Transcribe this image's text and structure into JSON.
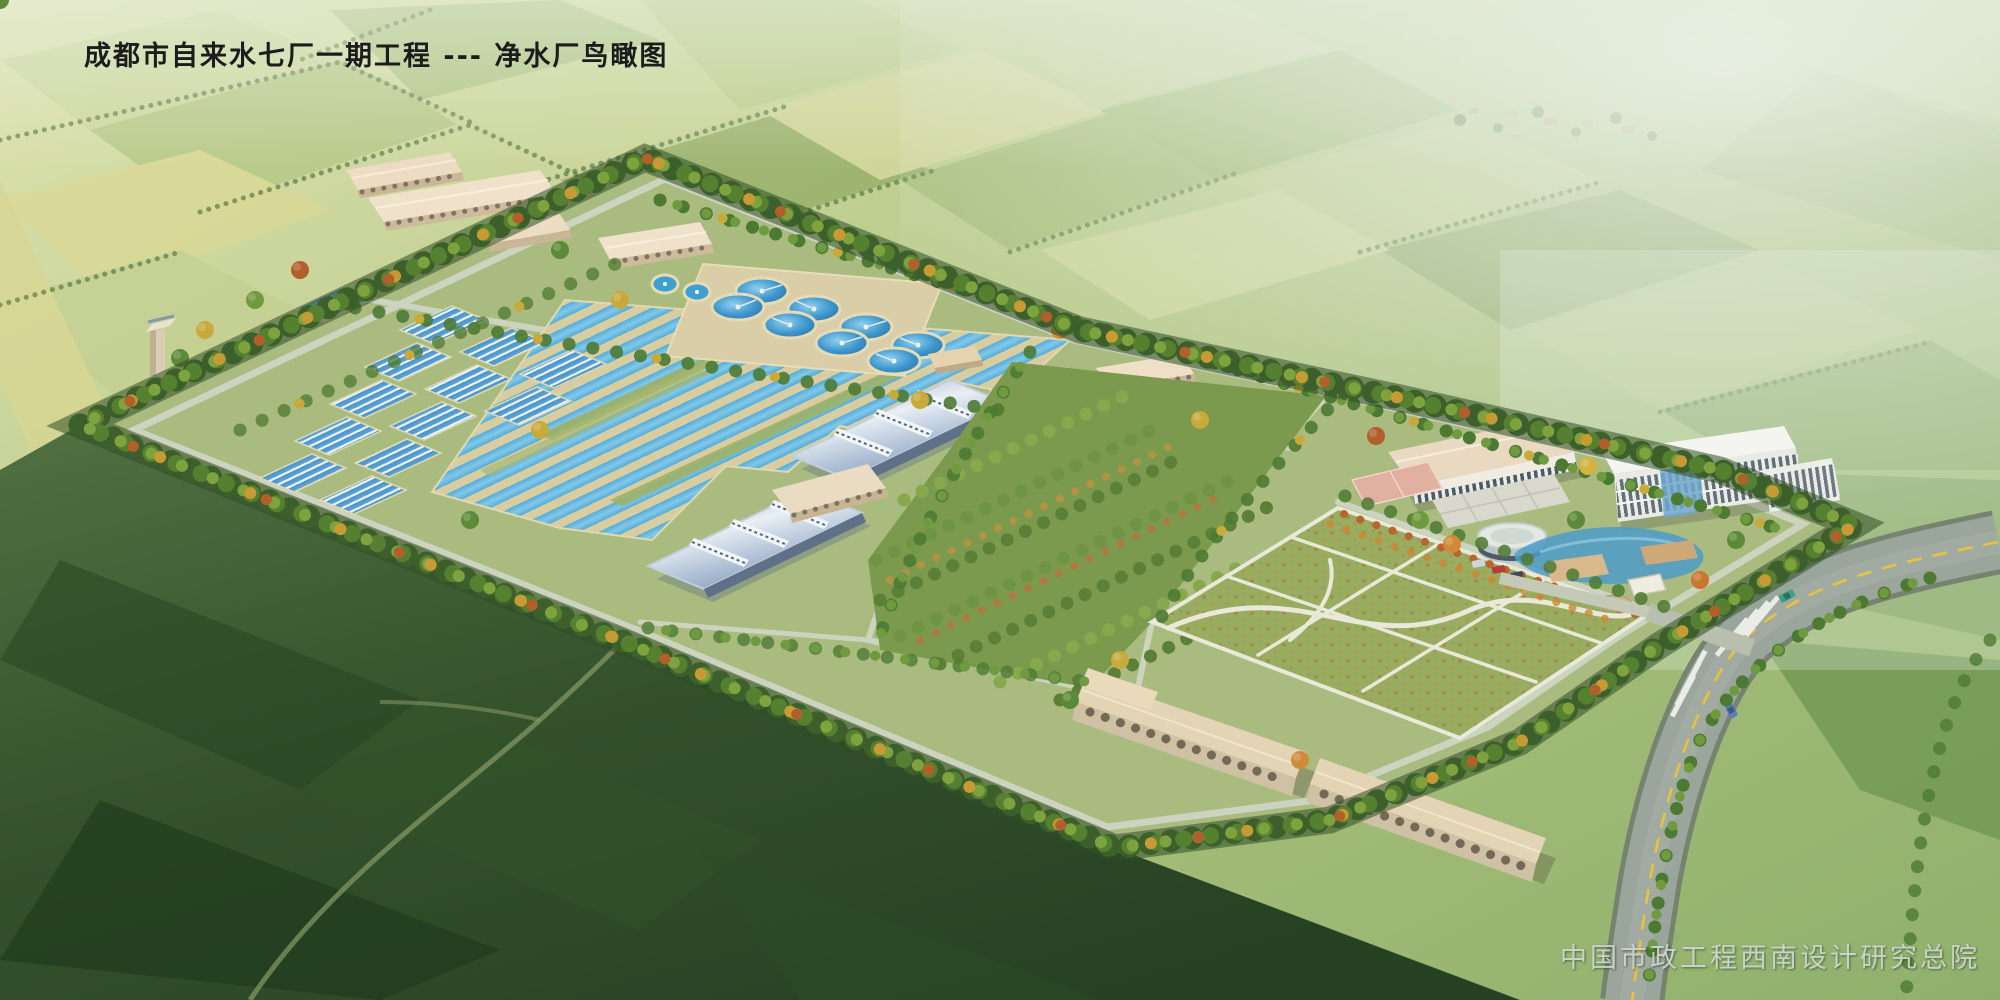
{
  "title": "成都市自来水七厂一期工程 --- 净水厂鸟瞰图",
  "credit": "中国市政工程西南设计研究总院",
  "scene": {
    "type": "architectural aerial perspective rendering",
    "subject_visible_in_title": "净水厂鸟瞰图",
    "circular_clarifiers": 8,
    "small_round_tanks": 2,
    "arch_roof_buildings": 2,
    "garage_rows": 2,
    "cars_on_highway": 3,
    "crosswalks": 2
  },
  "palette": {
    "field_light": "#d8dfae",
    "field_mid": "#a9bf7a",
    "field_dark": "#7fa05a",
    "haze": "#eaf2ec",
    "foreground_dark": "#27431f",
    "site_base": "#aabb80",
    "water_channel": "#5fb4de",
    "basin_wall": "#d8cda0",
    "panel_blue": "#4a92c8",
    "clarifier_blue": "#2e86c0",
    "roof_tan": "#e6d7bd",
    "roof_arch_blue": "#9fb4cc",
    "building_face": "#f2ece0",
    "office_white": "#f4f4f0",
    "tree_green": "#4f7a31",
    "tree_yellow": "#c9a93a",
    "tree_orange": "#b35f2c",
    "road_gray": "#9aa59b",
    "road_line_yellow": "#e8c33c",
    "path_light": "#e9e9da",
    "lawn_green": "#9aac60",
    "court_pink": "#e0b0a0",
    "pond_blue": "#4e9cc8",
    "title_color": "#1c1c1c",
    "credit_color": "#ccd5cc"
  }
}
